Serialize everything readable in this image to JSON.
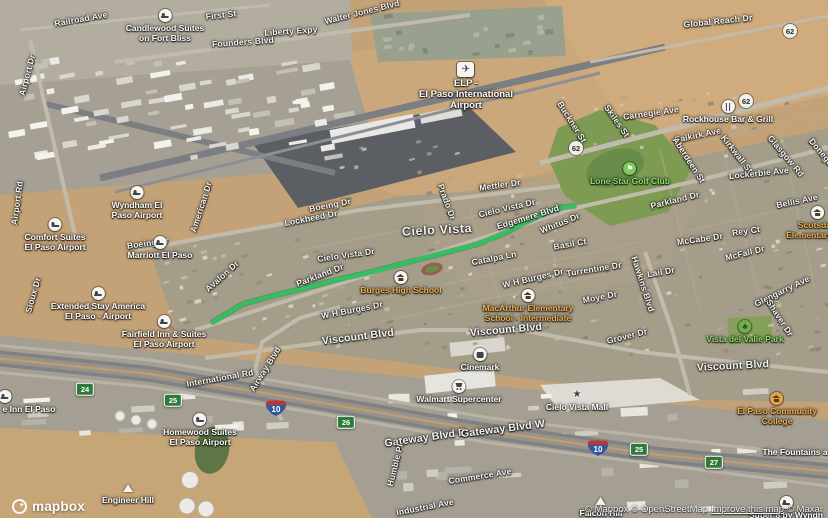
{
  "map": {
    "colors": {
      "route": "#2fc35f",
      "exit_shield": "#2f7a38",
      "interstate_blue": "#31599f",
      "interstate_red": "#b93632",
      "school_label": "#f0b04a",
      "park_label": "#8be06b"
    },
    "route": {
      "color": "#2fc35f",
      "points": [
        [
          213,
          322
        ],
        [
          243,
          304
        ],
        [
          272,
          296
        ],
        [
          305,
          288
        ],
        [
          340,
          279
        ],
        [
          375,
          271
        ],
        [
          412,
          261
        ],
        [
          448,
          252
        ],
        [
          478,
          244
        ],
        [
          503,
          234
        ],
        [
          526,
          222
        ],
        [
          547,
          212
        ],
        [
          564,
          207
        ],
        [
          574,
          206
        ]
      ]
    },
    "street_labels": [
      {
        "text": "Railroad Ave",
        "x": 81,
        "y": 19,
        "r": -10,
        "s": 1
      },
      {
        "text": "First St",
        "x": 221,
        "y": 15,
        "r": -6,
        "s": 1
      },
      {
        "text": "Founders Blvd",
        "x": 243,
        "y": 42,
        "r": -4,
        "s": 1
      },
      {
        "text": "Liberty Expy",
        "x": 291,
        "y": 31,
        "r": -4,
        "s": 1
      },
      {
        "text": "Walter Jones Blvd",
        "x": 362,
        "y": 12,
        "r": -14,
        "s": 1
      },
      {
        "text": "Global Reach Dr",
        "x": 718,
        "y": 21,
        "r": -6,
        "s": 1
      },
      {
        "text": "Airport Dr",
        "x": 27,
        "y": 75,
        "r": -75,
        "s": 1
      },
      {
        "text": "Airport Rd",
        "x": 17,
        "y": 203,
        "r": -82,
        "s": 1
      },
      {
        "text": "Carnegie Ave",
        "x": 651,
        "y": 113,
        "r": -8,
        "s": 1
      },
      {
        "text": "Buckner St",
        "x": 572,
        "y": 122,
        "r": 58,
        "s": 1
      },
      {
        "text": "Skiles St",
        "x": 617,
        "y": 121,
        "r": 55,
        "s": 1
      },
      {
        "text": "Falkirk Ave",
        "x": 698,
        "y": 135,
        "r": -12,
        "s": 1
      },
      {
        "text": "Aberdeen St",
        "x": 689,
        "y": 160,
        "r": 57,
        "s": 1
      },
      {
        "text": "Kirkwall St",
        "x": 737,
        "y": 154,
        "r": 52,
        "s": 1
      },
      {
        "text": "Glasgow Rd",
        "x": 786,
        "y": 156,
        "r": 50,
        "s": 1
      },
      {
        "text": "Donegal",
        "x": 822,
        "y": 153,
        "r": 50,
        "s": 1
      },
      {
        "text": "Lockerbie Ave",
        "x": 759,
        "y": 173,
        "r": -6,
        "s": 1
      },
      {
        "text": "Bellis Ave",
        "x": 797,
        "y": 201,
        "r": -12,
        "s": 1
      },
      {
        "text": "Parkland Dr",
        "x": 675,
        "y": 200,
        "r": -14,
        "s": 1
      },
      {
        "text": "McCabe Dr",
        "x": 700,
        "y": 239,
        "r": -8,
        "s": 1
      },
      {
        "text": "Rey Ct",
        "x": 746,
        "y": 231,
        "r": -8,
        "s": 1
      },
      {
        "text": "McFall Dr",
        "x": 745,
        "y": 253,
        "r": -14,
        "s": 1
      },
      {
        "text": "Glengarry Ave",
        "x": 782,
        "y": 291,
        "r": -26,
        "s": 1
      },
      {
        "text": "Shaver Dr",
        "x": 780,
        "y": 318,
        "r": 57,
        "s": 1
      },
      {
        "text": "Grover Dr",
        "x": 627,
        "y": 336,
        "r": -14,
        "s": 1
      },
      {
        "text": "Boeing Dr",
        "x": 330,
        "y": 205,
        "r": -11,
        "s": 1
      },
      {
        "text": "Boeing Dr",
        "x": 148,
        "y": 243,
        "r": -8,
        "s": 1
      },
      {
        "text": "Lockheed Dr",
        "x": 311,
        "y": 218,
        "r": -11,
        "s": 1
      },
      {
        "text": "American Dr",
        "x": 201,
        "y": 207,
        "r": -72,
        "s": 1
      },
      {
        "text": "Mettler Dr",
        "x": 500,
        "y": 185,
        "r": -8,
        "s": 1
      },
      {
        "text": "Cielo Vista Dr",
        "x": 507,
        "y": 208,
        "r": -13,
        "s": 1
      },
      {
        "text": "Cielo Vista Dr",
        "x": 346,
        "y": 255,
        "r": -8,
        "s": 1
      },
      {
        "text": "Edgemere Blvd",
        "x": 528,
        "y": 217,
        "r": -17,
        "s": 1
      },
      {
        "text": "Whitus Dr",
        "x": 560,
        "y": 223,
        "r": -22,
        "s": 1
      },
      {
        "text": "Basil Ct",
        "x": 570,
        "y": 244,
        "r": -10,
        "s": 1
      },
      {
        "text": "Catalpa Ln",
        "x": 494,
        "y": 258,
        "r": -11,
        "s": 1
      },
      {
        "text": "W H Burges Dr",
        "x": 533,
        "y": 278,
        "r": -13,
        "s": 1
      },
      {
        "text": "W H Burges Dr",
        "x": 352,
        "y": 310,
        "r": -11,
        "s": 1
      },
      {
        "text": "Turrentine Dr",
        "x": 594,
        "y": 269,
        "r": -9,
        "s": 1
      },
      {
        "text": "Moye Dr",
        "x": 600,
        "y": 297,
        "r": -11,
        "s": 1
      },
      {
        "text": "Hawkins Blvd",
        "x": 643,
        "y": 284,
        "r": 72,
        "s": 1
      },
      {
        "text": "Lail Dr",
        "x": 661,
        "y": 272,
        "r": -10,
        "s": 1
      },
      {
        "text": "Prado Dr",
        "x": 447,
        "y": 202,
        "r": 70,
        "s": 1
      },
      {
        "text": "Avalon Dr",
        "x": 222,
        "y": 276,
        "r": -42,
        "s": 1
      },
      {
        "text": "Parkland Dr",
        "x": 320,
        "y": 275,
        "r": -21,
        "s": 1
      },
      {
        "text": "Sioux Dr",
        "x": 33,
        "y": 295,
        "r": -74,
        "s": 1
      },
      {
        "text": "Viscount Blvd",
        "x": 358,
        "y": 337,
        "r": -7,
        "s": 2
      },
      {
        "text": "Viscount Blvd",
        "x": 506,
        "y": 330,
        "r": -5,
        "s": 2
      },
      {
        "text": "Viscount Blvd",
        "x": 733,
        "y": 366,
        "r": -3,
        "s": 2
      },
      {
        "text": "International Rd",
        "x": 220,
        "y": 378,
        "r": -10,
        "s": 1
      },
      {
        "text": "Airway Blvd",
        "x": 265,
        "y": 369,
        "r": -58,
        "s": 1
      },
      {
        "text": "Gateway Blvd E",
        "x": 425,
        "y": 438,
        "r": -8,
        "s": 2
      },
      {
        "text": "Gateway Blvd W",
        "x": 503,
        "y": 429,
        "r": -7,
        "s": 2
      },
      {
        "text": "Humble Pl",
        "x": 395,
        "y": 465,
        "r": -76,
        "s": 1
      },
      {
        "text": "Commerce Ave",
        "x": 480,
        "y": 476,
        "r": -9,
        "s": 1
      },
      {
        "text": "Industrial Ave",
        "x": 425,
        "y": 507,
        "r": -11,
        "s": 1
      },
      {
        "text": "Cielo Vista",
        "x": 437,
        "y": 230,
        "r": -3,
        "s": 3
      }
    ],
    "pois": [
      {
        "id": "elp-airport",
        "type": "airport",
        "x": 466,
        "y": 69,
        "lines": [
          "ELP -",
          "El Paso International",
          "Airport"
        ]
      },
      {
        "id": "candlewood-suites",
        "type": "hotel",
        "x": 165,
        "y": 16,
        "lines": [
          "Candlewood Suites",
          "on Fort Bliss"
        ]
      },
      {
        "id": "wyndham",
        "type": "hotel",
        "x": 137,
        "y": 193,
        "lines": [
          "Wyndham El",
          "Paso Airport"
        ]
      },
      {
        "id": "comfort-suites",
        "type": "hotel",
        "x": 55,
        "y": 225,
        "lines": [
          "Comfort Suites",
          "El Paso Airport"
        ]
      },
      {
        "id": "marriott",
        "type": "hotel",
        "x": 160,
        "y": 243,
        "lines": [
          "Marriott El Paso"
        ]
      },
      {
        "id": "extended-stay",
        "type": "hotel",
        "x": 98,
        "y": 294,
        "lines": [
          "Extended Stay America",
          "El Paso - Airport"
        ]
      },
      {
        "id": "fairfield-inn",
        "type": "hotel",
        "x": 164,
        "y": 322,
        "lines": [
          "Fairfield Inn & Suites",
          "El Paso Airport"
        ]
      },
      {
        "id": "homewood-suites",
        "type": "hotel",
        "x": 200,
        "y": 420,
        "lines": [
          "Homewood Suites",
          "El Paso Airport"
        ]
      },
      {
        "id": "inn-el-paso",
        "type": "hotel",
        "x": 5,
        "y": 397,
        "tx": 24,
        "lines": [
          "e Inn El Paso"
        ]
      },
      {
        "id": "super-8",
        "type": "hotel",
        "x": 786,
        "y": 503,
        "lines": [
          "Super 8 by Wyndh"
        ]
      },
      {
        "id": "rockhouse-bar-grill",
        "type": "restaurant",
        "x": 728,
        "y": 107,
        "lines": [
          "Rockhouse Bar & Grill"
        ]
      },
      {
        "id": "lone-star-golf-club",
        "type": "golf",
        "x": 630,
        "y": 169,
        "lines": [
          "Lone Star Golf Club"
        ]
      },
      {
        "id": "vista-del-valle-park",
        "type": "park",
        "x": 745,
        "y": 327,
        "lines": [
          "Vista del Valle Park"
        ]
      },
      {
        "id": "burges-high-school",
        "type": "school",
        "x": 401,
        "y": 278,
        "lines": [
          "Burges High School"
        ]
      },
      {
        "id": "macarthur-elementary",
        "type": "school",
        "x": 528,
        "y": 296,
        "lines": [
          "MacArthur Elementary",
          "School - Intermediate"
        ]
      },
      {
        "id": "scotsdale-elementary",
        "type": "school",
        "x": 818,
        "y": 213,
        "lines": [
          "Scotsdale",
          "Elementary Sch"
        ]
      },
      {
        "id": "el-paso-community-college",
        "type": "college",
        "x": 777,
        "y": 399,
        "lines": [
          "El Paso Community",
          "College"
        ]
      },
      {
        "id": "cinemark",
        "type": "cinema",
        "x": 480,
        "y": 355,
        "lines": [
          "Cinemark"
        ]
      },
      {
        "id": "walmart-supercenter",
        "type": "store",
        "x": 459,
        "y": 387,
        "lines": [
          "Walmart Supercenter"
        ]
      },
      {
        "id": "cielo-vista-mall",
        "type": "mall",
        "x": 577,
        "y": 395,
        "lines": [
          "Cielo Vista Mall"
        ]
      },
      {
        "id": "the-fountains",
        "type": "plain",
        "x": 795,
        "y": 446,
        "lines": [
          "The Fountains a"
        ]
      },
      {
        "id": "engineer-hill",
        "type": "hill",
        "x": 128,
        "y": 488,
        "lines": [
          "Engineer Hill"
        ]
      },
      {
        "id": "falcon-hill",
        "type": "hill",
        "x": 601,
        "y": 501,
        "lines": [
          "Falcon Hill"
        ]
      }
    ],
    "shields": [
      {
        "kind": "us",
        "label": "62",
        "x": 790,
        "y": 31
      },
      {
        "kind": "us",
        "label": "62",
        "x": 746,
        "y": 101
      },
      {
        "kind": "us",
        "label": "62",
        "x": 576,
        "y": 148
      },
      {
        "kind": "exit",
        "label": "24",
        "x": 85,
        "y": 389
      },
      {
        "kind": "exit",
        "label": "25",
        "x": 173,
        "y": 400
      },
      {
        "kind": "exit",
        "label": "26",
        "x": 346,
        "y": 422
      },
      {
        "kind": "exit",
        "label": "25",
        "x": 639,
        "y": 449
      },
      {
        "kind": "exit",
        "label": "27",
        "x": 714,
        "y": 462
      },
      {
        "kind": "interstate",
        "label": "10",
        "x": 276,
        "y": 408
      },
      {
        "kind": "interstate",
        "label": "10",
        "x": 598,
        "y": 448
      }
    ],
    "attribution": {
      "logo_text": "mapbox",
      "seg_mapbox": "© Mapbox",
      "seg_osm": "© OpenStreetMap",
      "seg_improve": "Improve this map",
      "seg_maxar": "© Maxar"
    }
  }
}
